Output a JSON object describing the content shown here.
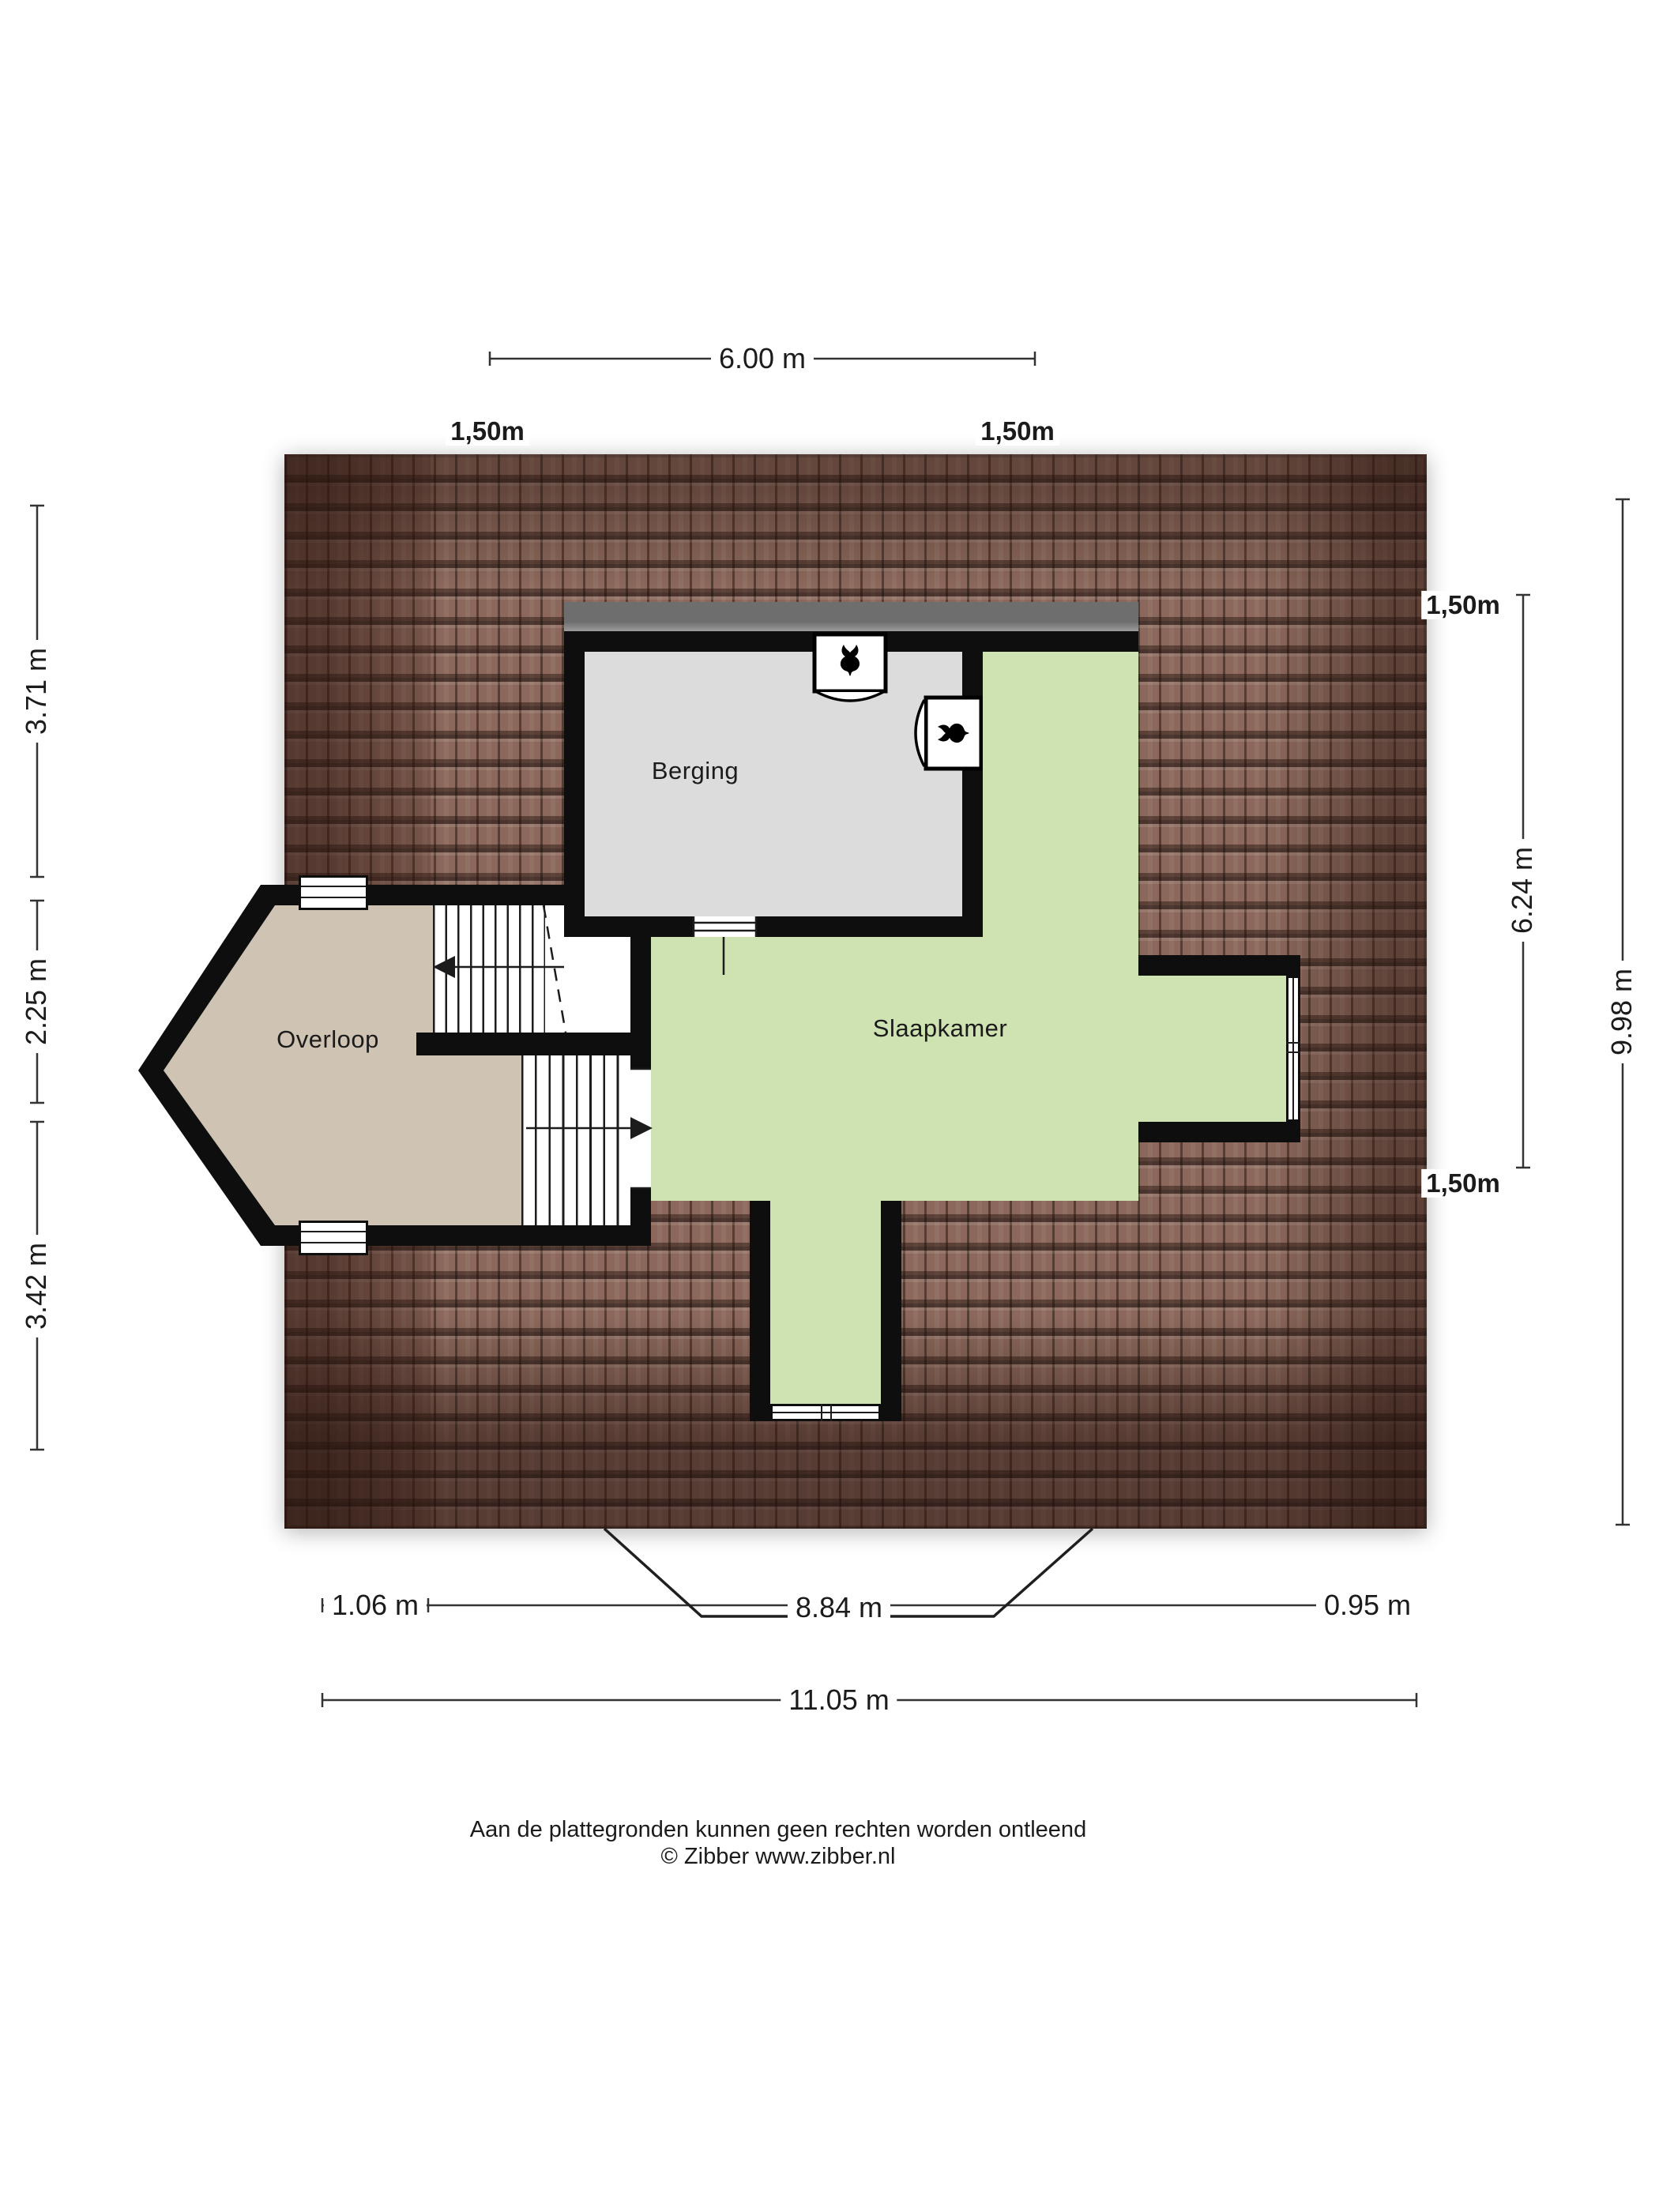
{
  "plan": {
    "rooms": [
      {
        "label": "Berging"
      },
      {
        "label": "Slaapkamer"
      },
      {
        "label": "Overloop"
      }
    ],
    "icons": [
      "mechanical-ventilation-icon",
      "mechanical-ventilation-icon",
      "stair-up-arrow-icon",
      "stair-down-arrow-icon"
    ],
    "colors": {
      "roof_tile": "#8b685b",
      "roof_grout": "#3a241b",
      "wall": "#0e0e0e",
      "berging_floor": "#dcdcdc",
      "slaapkamer_floor": "#cfe2b2",
      "overloop_floor": "#cfc4b4",
      "flat_roof": "#6e6e6e"
    }
  },
  "dimensions": {
    "top_width": {
      "label": "6.00 m"
    },
    "top_offsets": [
      {
        "label": "1,50m"
      },
      {
        "label": "1,50m"
      }
    ],
    "left_segments": [
      {
        "label": "3.71 m"
      },
      {
        "label": "2.25 m"
      },
      {
        "label": "3.42 m"
      }
    ],
    "right": {
      "offset_top": "1,50m",
      "inner": "6.24 m",
      "offset_bottom": "1,50m",
      "outer": "9.98 m"
    },
    "bottom": {
      "left_overhang": "1.06 m",
      "wall_width": "8.84 m",
      "right_overhang": "0.95 m",
      "total": "11.05 m"
    }
  },
  "footer": {
    "line1": "Aan de plattegronden kunnen geen rechten worden ontleend",
    "line2": "© Zibber www.zibber.nl"
  }
}
